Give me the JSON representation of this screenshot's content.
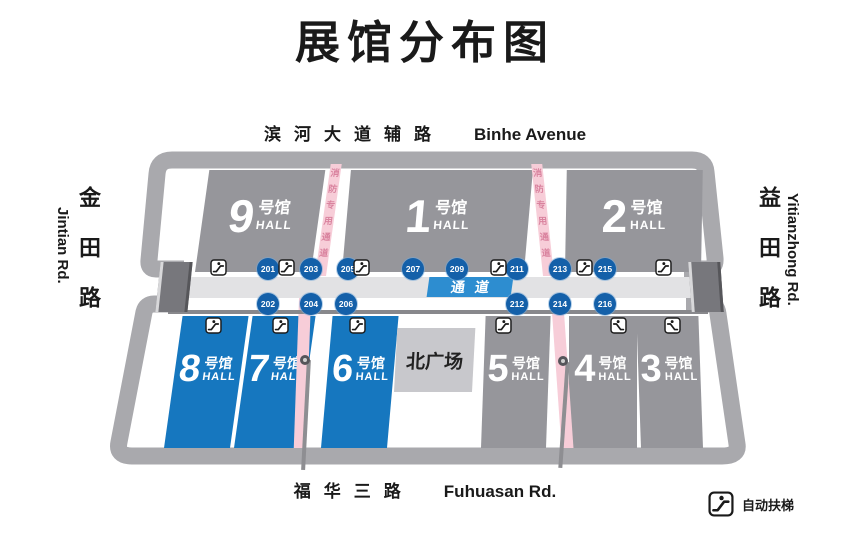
{
  "title": "展馆分布图",
  "roads": {
    "top_zh": "滨河大道辅路",
    "top_en": "Binhe Avenue",
    "bottom_zh": "福华三路",
    "bottom_en": "Fuhuasan Rd.",
    "left_zh": "金田路",
    "left_en": "Jintian Rd.",
    "right_zh": "益田路",
    "right_en": "Yitianzhong Rd."
  },
  "halls": [
    {
      "num": "9",
      "suffix": "号馆",
      "hall": "HALL",
      "type": "gray"
    },
    {
      "num": "1",
      "suffix": "号馆",
      "hall": "HALL",
      "type": "gray"
    },
    {
      "num": "2",
      "suffix": "号馆",
      "hall": "HALL",
      "type": "gray"
    },
    {
      "num": "8",
      "suffix": "号馆",
      "hall": "HALL",
      "type": "blue"
    },
    {
      "num": "7",
      "suffix": "号馆",
      "hall": "HALL",
      "type": "blue"
    },
    {
      "num": "6",
      "suffix": "号馆",
      "hall": "HALL",
      "type": "blue"
    },
    {
      "num": "5",
      "suffix": "号馆",
      "hall": "HALL",
      "type": "gray"
    },
    {
      "num": "4",
      "suffix": "号馆",
      "hall": "HALL",
      "type": "gray"
    },
    {
      "num": "3",
      "suffix": "号馆",
      "hall": "HALL",
      "type": "gray"
    }
  ],
  "plaza_label": "北广场",
  "corridor_label": "通道",
  "gates_top": [
    "201",
    "203",
    "205",
    "207",
    "209",
    "211",
    "213",
    "215"
  ],
  "gates_bottom": [
    "202",
    "204",
    "206",
    "212",
    "214",
    "216"
  ],
  "fire_lane_label": "消防专用通道",
  "legend_label": "自动扶梯",
  "colors": {
    "hall_gray": "#96969b",
    "hall_blue": "#1677bf",
    "plaza_gray": "#c8c8cc",
    "outline_gray": "#a9a9ad",
    "corridor_gray": "#e2e2e4",
    "gate_blue": "#1460a9",
    "corridor_label_blue": "#2d8dd0",
    "fire_lane_pink": "#f7cdd8"
  }
}
